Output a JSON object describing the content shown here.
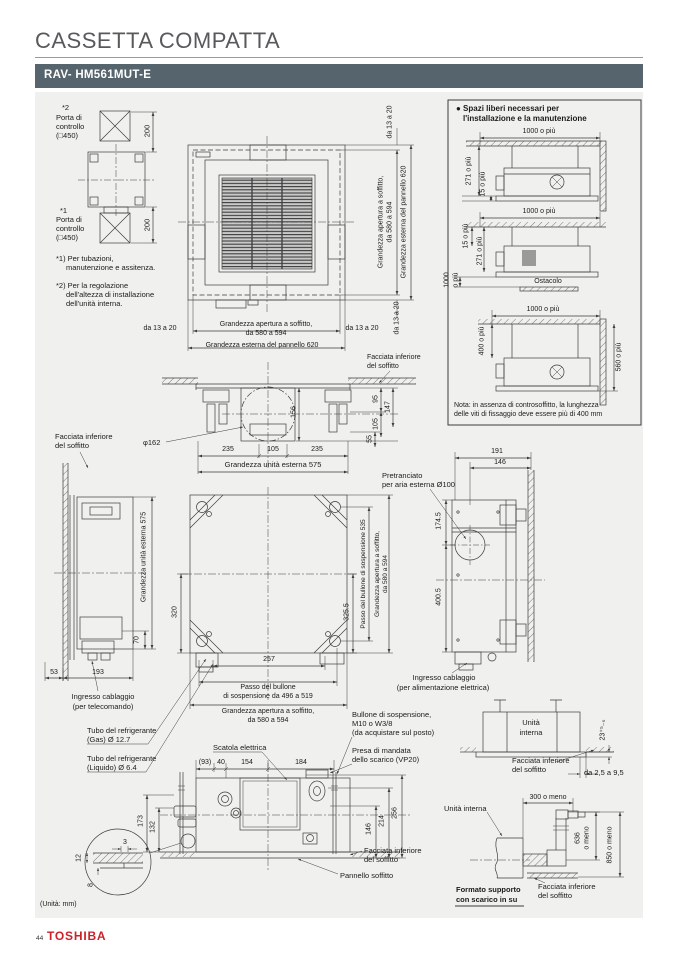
{
  "page": {
    "title": "CASSETTA COMPATTA",
    "model": "RAV- HM561MUT-E",
    "units_note": "(Unità: mm)",
    "page_number": "44",
    "brand": "TOSHIBA"
  },
  "colors": {
    "header_bg": "#56646d",
    "panel_bg": "#f0f0ee",
    "brand_red": "#cb2128",
    "line": "#3d3d3d"
  },
  "access": {
    "ref2": "*2",
    "porta2_l1": "Porta di",
    "porta2_l2": "controllo",
    "porta2_l3": "(□450)",
    "dim_top": "200",
    "ref1": "*1",
    "porta1_l1": "Porta di",
    "porta1_l2": "controllo",
    "porta1_l3": "(□450)",
    "dim_bottom": "200",
    "note1_l1": "*1) Per tubazioni,",
    "note1_l2": "manutenzione e assitenza.",
    "note2_l1": "*2) Per la regolazione",
    "note2_l2": "dell'altezza di installazione",
    "note2_l3": "dell'unità interna."
  },
  "top_plan": {
    "gap_top": "da 13 a 20",
    "apertura_l1": "Grandezza apertura a soffitto,",
    "apertura_l2": "da 580 a 594",
    "pannello": "Grandezza esterna del pannello 620",
    "gap_bottom_rot": "da 13 a 20",
    "gap_left": "da 13 a 20",
    "gap_right": "da 13 a 20",
    "apertura_b_l1": "Grandezza apertura a soffitto,",
    "apertura_b_l2": "da 580 a 594",
    "pannello_b": "Grandezza esterna del pannello 620",
    "facciata_l1": "Facciata inferiore",
    "facciata_l2": "del soffitto"
  },
  "spazi": {
    "title_l1": "● Spazi liberi necessari per",
    "title_l2": "l'installazione e la manutenzione",
    "d1_top": "1000 o più",
    "d1_h": "271 o più",
    "d1_gap": "15 o più",
    "d2_top": "1000 o più",
    "d2_gap": "15 o più",
    "d2_h": "271 o più",
    "d2_clear_l1": "1000",
    "d2_clear_l2": "o più",
    "d2_obstacle": "Ostacolo",
    "d3_top": "1000 o più",
    "d3_rod": "400 o più",
    "d3_side": "560 o più",
    "nota_l1": "Nota: in assenza di controsoffitto, la lunghezza",
    "nota_l2": "delle viti di fissaggio deve essere più di 400 mm"
  },
  "section": {
    "dia": "φ162",
    "d95": "95",
    "d147": "147",
    "d156": "156",
    "d105r": "105",
    "d55": "55",
    "d235l": "235",
    "d105": "105",
    "d235r": "235",
    "unita": "Grandezza unità esterna 575"
  },
  "left_view": {
    "facciata_l1": "Facciata inferiore",
    "facciata_l2": "del soffitto",
    "unita": "Grandezza unità esterna 575",
    "d70": "70",
    "d53": "53",
    "d193": "193",
    "ingresso_l1": "Ingresso cablaggio",
    "ingresso_l2": "(per telecomando)"
  },
  "bottom_plan": {
    "d320": "320",
    "d3255": "325.5",
    "passo_v": "Passo del bullone di sospensione 535",
    "apertura_l1": "Grandezza apertura a soffitto,",
    "apertura_l2": "da 580 a 594",
    "d257": "257",
    "passo_b_l1": "Passo del bullone",
    "passo_b_l2": "di sospensione da 496 a 519",
    "apertura_b_l1": "Grandezza apertura a soffitto,",
    "apertura_b_l2": "da 580 a 594"
  },
  "right_view": {
    "d191": "191",
    "d146": "146",
    "pretranciato_l1": "Pretranciato",
    "pretranciato_l2": "per aria esterna Ø100",
    "d1745": "174.5",
    "d4005": "400.5",
    "ingresso_l1": "Ingresso cablaggio",
    "ingresso_l2": "(per alimentazione elettrica)"
  },
  "bottom_section": {
    "tubo_gas_l1": "Tubo del refrigerante",
    "tubo_gas_l2": "(Gas) Ø 12.7",
    "tubo_liq_l1": "Tubo del refrigerante",
    "tubo_liq_l2": "(Liquido) Ø 6.4",
    "scatola": "Scatola elettrica",
    "bullone_l1": "Bullone di sospensione,",
    "bullone_l2": "M10 o W3/8",
    "bullone_l3": "(da acquistare sul posto)",
    "presa_l1": "Presa di mandata",
    "presa_l2": "dello scarico (VP20)",
    "d93": "(93)",
    "d40": "40",
    "d154": "154",
    "d184": "184",
    "d173": "173",
    "d132": "132",
    "d146": "146",
    "d214": "214",
    "d256": "256",
    "det3": "3",
    "det12": "12",
    "det8": "8",
    "facciata_l1": "Facciata inferiore",
    "facciata_l2": "del soffitto",
    "pannello": "Pannello soffitto"
  },
  "detail_a": {
    "unita_l1": "Unità",
    "unita_l2": "interna",
    "tol": "23⁺⁵₋₀",
    "facciata_l1": "Facciata inferiore",
    "facciata_l2": "del soffitto",
    "range": "da 2,5 a 9,5"
  },
  "detail_b": {
    "d300": "300 o meno",
    "unita": "Unità interna",
    "d636_l1": "636",
    "d636_l2": "o meno",
    "d850": "850 o meno",
    "facciata_l1": "Facciata inferiore",
    "facciata_l2": "del soffitto",
    "formato_l1": "Formato supporto",
    "formato_l2": "con scarico in su"
  }
}
